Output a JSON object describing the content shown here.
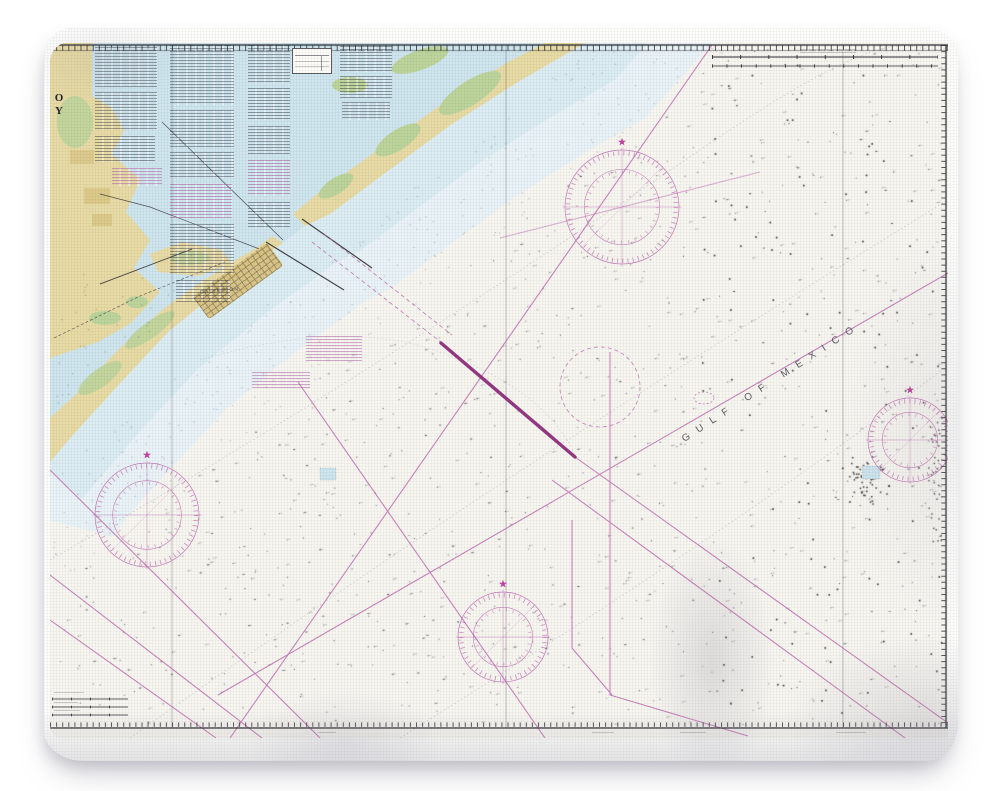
{
  "blanket": {
    "fabric_color": "#fdfdfc"
  },
  "chart": {
    "paper_color": "#f8f6f1",
    "title_fragments": {
      "line1": "O",
      "line2": "Y"
    },
    "labels": {
      "sea": "GULF OF MEXICO",
      "city": "GALVESTON"
    },
    "colors": {
      "fabric": "#fdfdfc",
      "paper": "#f8f6f1",
      "water": "#cfe6ef",
      "water_mid": "#dcedf4",
      "water_light": "#eaf4f8",
      "land": "#e8dba6",
      "land_dark": "#d9c584",
      "marsh": "#bdd59c",
      "magenta": "#bb63ac",
      "magenta_dark": "#8e2d7c",
      "star": "#c2379f",
      "ink": "#2e2e34",
      "contour": "#9aa8ad"
    },
    "compass_roses": [
      {
        "cx": 622,
        "cy": 207,
        "r": 57
      },
      {
        "cx": 147,
        "cy": 515,
        "r": 52
      },
      {
        "cx": 503,
        "cy": 637,
        "r": 45
      },
      {
        "cx": 910,
        "cy": 440,
        "r": 42
      }
    ],
    "note_blocks": [
      {
        "x": 95,
        "y": 47,
        "w": 62,
        "h": 40,
        "tone": "black"
      },
      {
        "x": 95,
        "y": 92,
        "w": 62,
        "h": 38,
        "tone": "black"
      },
      {
        "x": 95,
        "y": 136,
        "w": 60,
        "h": 26,
        "tone": "black"
      },
      {
        "x": 170,
        "y": 45,
        "w": 64,
        "h": 60,
        "tone": "black"
      },
      {
        "x": 170,
        "y": 110,
        "w": 64,
        "h": 38,
        "tone": "black"
      },
      {
        "x": 170,
        "y": 152,
        "w": 64,
        "h": 26,
        "tone": "black"
      },
      {
        "x": 170,
        "y": 184,
        "w": 62,
        "h": 34,
        "tone": "magenta"
      },
      {
        "x": 170,
        "y": 224,
        "w": 64,
        "h": 50,
        "tone": "black"
      },
      {
        "x": 176,
        "y": 280,
        "w": 54,
        "h": 22,
        "tone": "black"
      },
      {
        "x": 248,
        "y": 45,
        "w": 42,
        "h": 38,
        "tone": "black"
      },
      {
        "x": 248,
        "y": 88,
        "w": 42,
        "h": 32,
        "tone": "black"
      },
      {
        "x": 248,
        "y": 126,
        "w": 42,
        "h": 28,
        "tone": "black"
      },
      {
        "x": 248,
        "y": 160,
        "w": 42,
        "h": 36,
        "tone": "magenta"
      },
      {
        "x": 248,
        "y": 202,
        "w": 42,
        "h": 26,
        "tone": "black"
      },
      {
        "x": 340,
        "y": 46,
        "w": 52,
        "h": 26,
        "tone": "black"
      },
      {
        "x": 340,
        "y": 76,
        "w": 52,
        "h": 22,
        "tone": "black"
      },
      {
        "x": 342,
        "y": 102,
        "w": 48,
        "h": 18,
        "tone": "black"
      },
      {
        "x": 112,
        "y": 168,
        "w": 50,
        "h": 18,
        "tone": "magenta"
      },
      {
        "x": 306,
        "y": 336,
        "w": 56,
        "h": 26,
        "tone": "magenta"
      },
      {
        "x": 252,
        "y": 372,
        "w": 58,
        "h": 16,
        "tone": "magenta"
      },
      {
        "x": 800,
        "y": 49,
        "w": 56,
        "h": 4,
        "tone": "faint"
      },
      {
        "x": 236,
        "y": 39,
        "w": 44,
        "h": 3,
        "tone": "faint"
      },
      {
        "x": 548,
        "y": 40,
        "w": 30,
        "h": 3,
        "tone": "faint"
      },
      {
        "x": 754,
        "y": 40,
        "w": 44,
        "h": 3,
        "tone": "faint"
      },
      {
        "x": 592,
        "y": 732,
        "w": 22,
        "h": 3,
        "tone": "faint"
      },
      {
        "x": 680,
        "y": 732,
        "w": 26,
        "h": 3,
        "tone": "faint"
      },
      {
        "x": 836,
        "y": 732,
        "w": 30,
        "h": 3,
        "tone": "faint"
      },
      {
        "x": 318,
        "y": 732,
        "w": 18,
        "h": 3,
        "tone": "faint"
      },
      {
        "x": 54,
        "y": 692,
        "w": 30,
        "h": 3,
        "tone": "faint"
      },
      {
        "x": 54,
        "y": 702,
        "w": 24,
        "h": 3,
        "tone": "faint"
      },
      {
        "x": 54,
        "y": 710,
        "w": 26,
        "h": 3,
        "tone": "faint"
      }
    ]
  },
  "decor": {
    "seed": 11332,
    "dots": {
      "gulf": 950,
      "band": 260,
      "bay": 45,
      "platforms": 110,
      "cluster": 55,
      "edge": 35,
      "noise": 380
    }
  }
}
